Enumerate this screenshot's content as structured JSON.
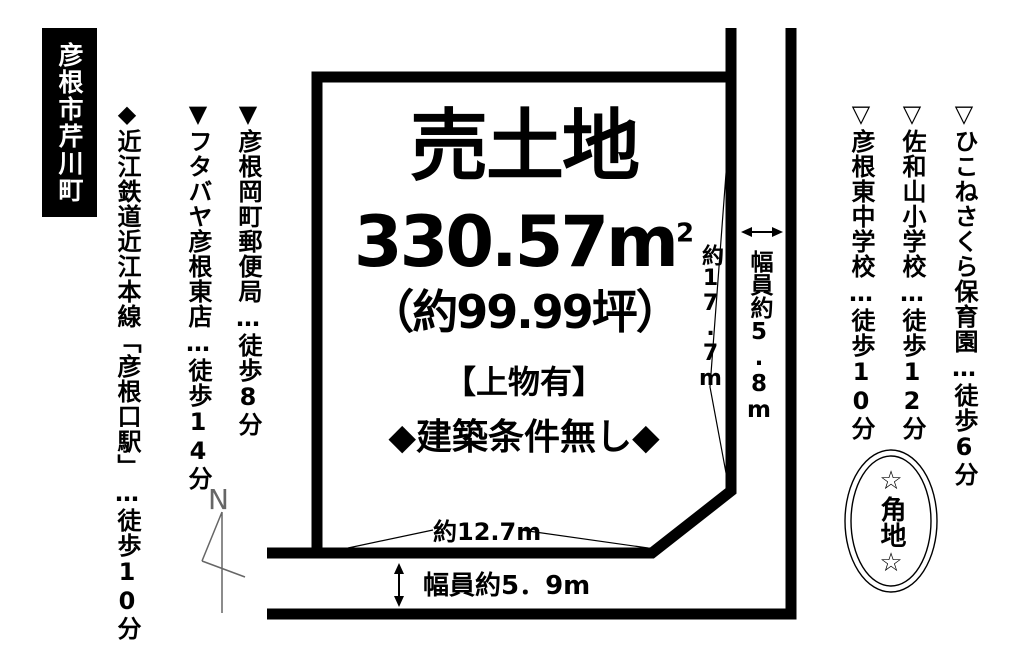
{
  "location_box": {
    "label": "彦根市芹川町"
  },
  "plot": {
    "title": "売土地",
    "area_m2": "330.57m",
    "area_sup": "2",
    "area_tsubo": "（約99.99坪）",
    "building_note": "【上物有】",
    "condition_note": "◆建築条件無し◆"
  },
  "dimensions": {
    "right_edge_length": "約17.7m",
    "bottom_edge_length": "約12.7m",
    "right_road_width": "幅員約5.8m",
    "bottom_road_width": "幅員約5．9m"
  },
  "nearby_left": [
    "◆近江鉄道近江本線「彦根口駅」…徒歩10分",
    "▼フタバヤ彦根東店…徒歩14分",
    "▼彦根岡町郵便局…徒歩8分"
  ],
  "nearby_right": [
    "▽彦根東中学校…徒歩10分",
    "▽佐和山小学校…徒歩12分",
    "▽ひこねさくら保育園…徒歩6分"
  ],
  "corner_badge": {
    "label": "☆角地☆"
  },
  "compass": {
    "label": "N"
  },
  "colors": {
    "ink": "#000000",
    "paper": "#ffffff",
    "compass": "#666666"
  }
}
